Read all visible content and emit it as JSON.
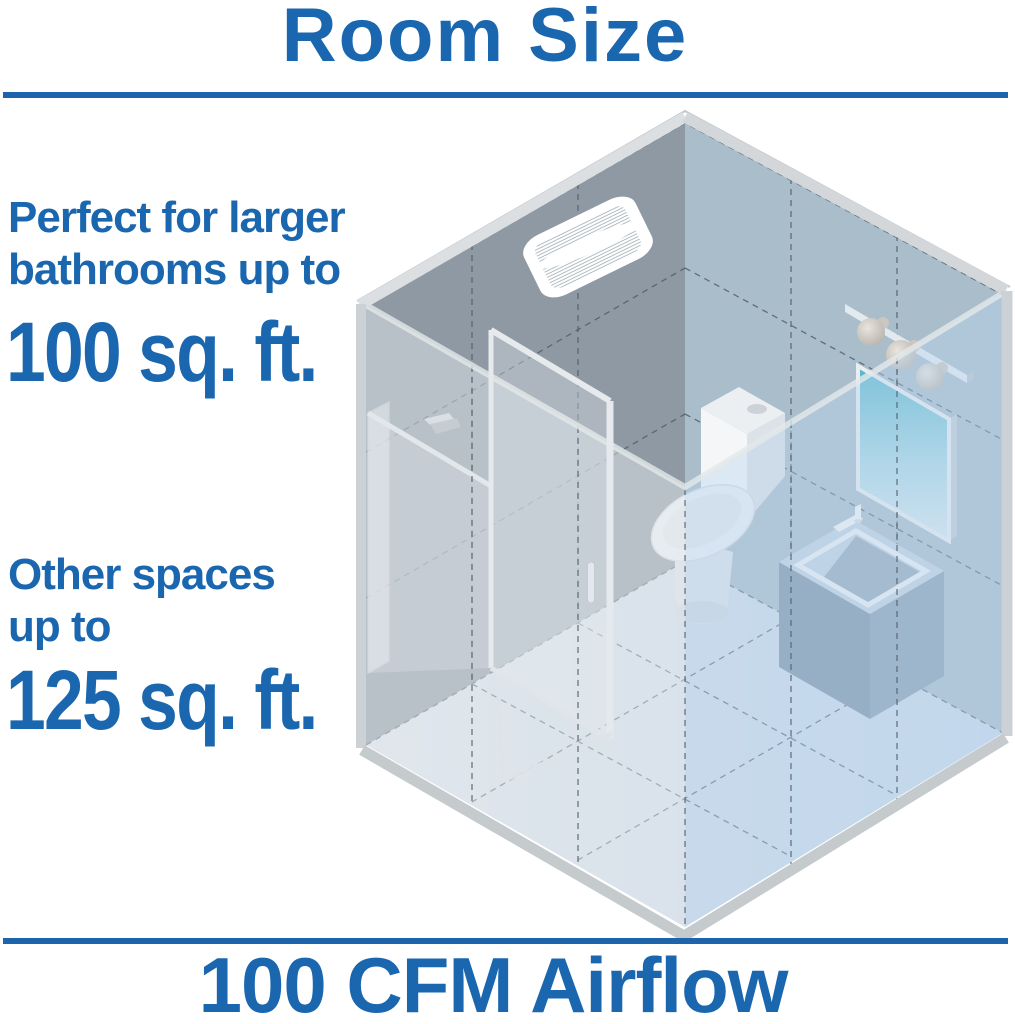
{
  "header": {
    "title": "Room Size"
  },
  "callouts": {
    "primary": {
      "line1": "Perfect for larger",
      "line2": "bathrooms up to",
      "value": "100 sq. ft."
    },
    "secondary": {
      "line1": "Other spaces",
      "line2": "up to",
      "value": "125 sq. ft."
    }
  },
  "footer": {
    "label": "100 CFM Airflow"
  },
  "colors": {
    "accent_text": "#1a67b0",
    "divider": "#1d64ad",
    "wall_left": "#8e99a3",
    "wall_right": "#a9bdcb",
    "floor_left": "#dfe5ea",
    "floor_right": "#c9daec",
    "trim": "#d3d7da",
    "mirror_teal": "#54b5ca"
  },
  "illustration": {
    "type": "isometric-bathroom-cutaway",
    "fixtures": [
      "ceiling-exhaust-fan-grille",
      "shower-enclosure",
      "shower-head",
      "toilet",
      "vanity-sink",
      "vanity-mirror",
      "vanity-lights"
    ]
  }
}
